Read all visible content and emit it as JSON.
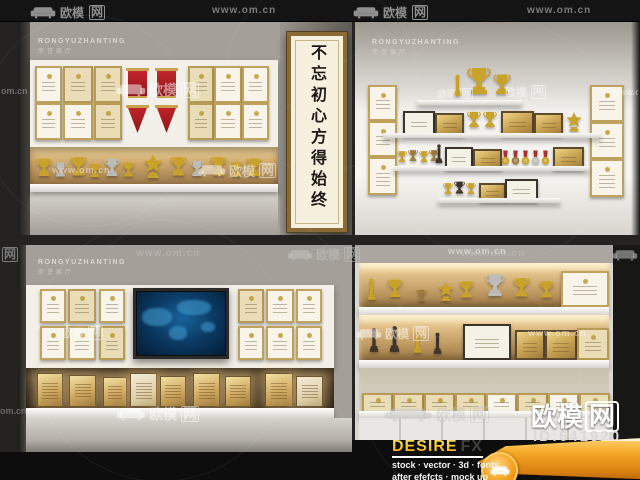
{
  "watermark": {
    "brand_prefix": "欧模",
    "brand_boxed": "网",
    "url": "www.om.cn",
    "url_short": "om.cn"
  },
  "scene": {
    "label_en": "RONGYUZHANTING",
    "label_cn": "荣誉展厅",
    "calligraphy": "不忘初心方得始终"
  },
  "footer": {
    "desire": "DESIRE",
    "fx": "FX",
    "tagline1": "stock · vector · 3d · fonts",
    "tagline2": "after efefcts · mock up",
    "brand_prefix": "欧模",
    "brand_boxed": "网",
    "id": "ID:641920"
  }
}
